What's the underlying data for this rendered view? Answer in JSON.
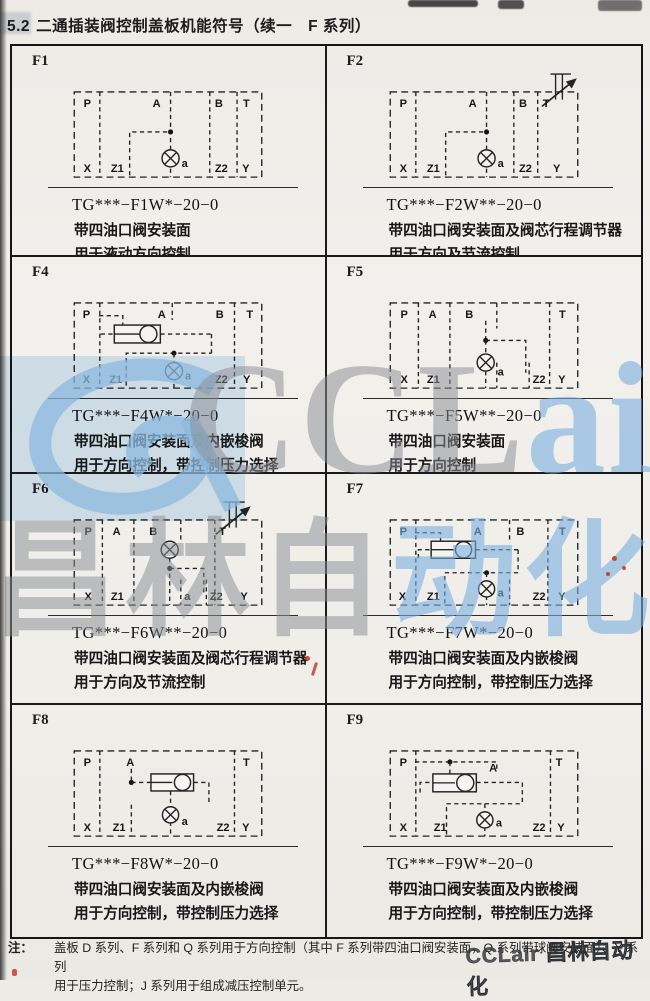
{
  "page": {
    "section": "5.2",
    "title": "二通插装阀控制盖板机能符号（续一　F 系列）",
    "note": {
      "label": "注：",
      "line1": "盖板 D 系列、F 系列和 Q 系列用于方向控制（其中 F 系列带四油口阀安装面，Q 系列带球阀安装面）、Y 系列",
      "line2": "用于压力控制；J 系列用于组成减压控制单元。"
    },
    "watermark": {
      "latin_gray": "CCL",
      "latin_blue": "air",
      "cjk_gray": "昌林自",
      "cjk_blue": "动化",
      "corner": "CCLair 昌林自动化",
      "blue": "#7aadde",
      "gray": "#8a8e93"
    }
  },
  "cells": [
    {
      "id": "F1",
      "model": "TG***−F1W*−20−0",
      "desc1": "带四油口阀安装面",
      "desc2": "用于液动方向控制",
      "ports_top": [
        "P",
        "A",
        "B",
        "T"
      ],
      "ports_bottom": [
        "X",
        "Z1",
        "a",
        "Z2",
        "Y"
      ]
    },
    {
      "id": "F2",
      "model": "TG***−F2W**−20−0",
      "desc1": "带四油口阀安装面及阀芯行程调节器",
      "desc2": "用于方向及节流控制",
      "ports_top": [
        "P",
        "A",
        "B",
        "T"
      ],
      "ports_bottom": [
        "X",
        "Z1",
        "a",
        "Z2",
        "Y"
      ]
    },
    {
      "id": "F4",
      "model": "TG***−F4W*−20−0",
      "desc1": "带四油口阀安装面及内嵌梭阀",
      "desc2": "用于方向控制，带控制压力选择",
      "ports_top": [
        "P",
        "A",
        "B",
        "T"
      ],
      "ports_bottom": [
        "X",
        "Z1",
        "a",
        "Z2",
        "Y"
      ]
    },
    {
      "id": "F5",
      "model": "TG***−F5W**−20−0",
      "desc1": "带四油口阀安装面",
      "desc2": "用于方向控制",
      "ports_top": [
        "P",
        "A",
        "B",
        "T"
      ],
      "ports_bottom": [
        "X",
        "Z1",
        "a",
        "Z2",
        "Y"
      ]
    },
    {
      "id": "F6",
      "model": "TG***−F6W**−20−0",
      "desc1": "带四油口阀安装面及阀芯行程调节器",
      "desc2": "用于方向及节流控制",
      "ports_top": [
        "P",
        "A",
        "B",
        "T"
      ],
      "ports_bottom": [
        "X",
        "Z1",
        "a",
        "Z2",
        "Y"
      ]
    },
    {
      "id": "F7",
      "model": "TG***−F7W*−20−0",
      "desc1": "带四油口阀安装面及内嵌梭阀",
      "desc2": "用于方向控制，带控制压力选择",
      "ports_top": [
        "P",
        "A",
        "B",
        "T"
      ],
      "ports_bottom": [
        "X",
        "Z1",
        "a",
        "Z2",
        "Y"
      ]
    },
    {
      "id": "F8",
      "model": "TG***−F8W*−20−0",
      "desc1": "带四油口阀安装面及内嵌梭阀",
      "desc2": "用于方向控制，带控制压力选择",
      "ports_top": [
        "P",
        "A",
        "T"
      ],
      "ports_bottom": [
        "X",
        "Z1",
        "a",
        "Z2",
        "Y"
      ]
    },
    {
      "id": "F9",
      "model": "TG***−F9W*−20−0",
      "desc1": "带四油口阀安装面及内嵌梭阀",
      "desc2": "用于方向控制，带控制压力选择",
      "ports_top": [
        "P",
        "A",
        "T"
      ],
      "ports_bottom": [
        "X",
        "Z1",
        "a",
        "Z2",
        "Y"
      ]
    }
  ]
}
